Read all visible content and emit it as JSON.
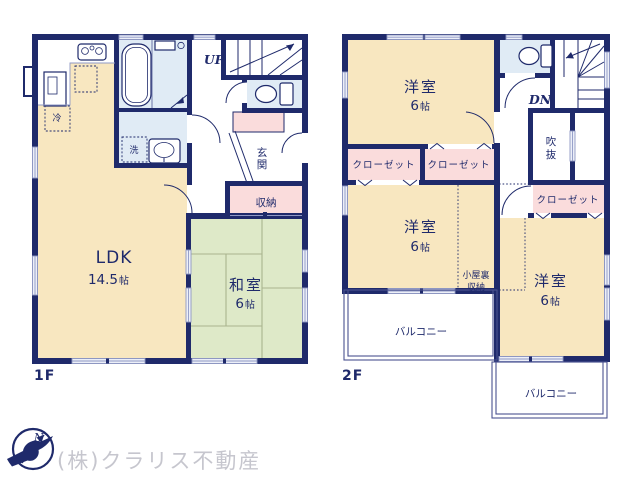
{
  "title": "floor-plan",
  "colors": {
    "wall_navy": "#1f2a6b",
    "ldk_cream": "#f8e7c0",
    "tatami_green": "#dee9c8",
    "wet_area_blue": "#e0ebf5",
    "storage_pink": "#fadcdc",
    "window_light": "#eceff8",
    "tatami_line": "#a9b48e",
    "company_gray": "#c6c6ce"
  },
  "floor1": {
    "label": "1F",
    "ldk": {
      "name": "LDK",
      "size_num": "14.5",
      "size_unit": "帖"
    },
    "washitsu": {
      "name": "和室",
      "size_num": "6",
      "size_unit": "帖"
    },
    "genkan": {
      "line1": "玄",
      "line2": "関"
    },
    "storage": "収納",
    "fridge": "冷",
    "laundry": "洗",
    "stairs": "UP"
  },
  "floor2": {
    "label": "2F",
    "rooms": [
      {
        "name": "洋室",
        "size_num": "6",
        "size_unit": "帖"
      },
      {
        "name": "洋室",
        "size_num": "6",
        "size_unit": "帖"
      },
      {
        "name": "洋室",
        "size_num": "6",
        "size_unit": "帖"
      }
    ],
    "closet": "クローゼット",
    "void": {
      "line1": "吹",
      "line2": "抜"
    },
    "attic": {
      "line1": "小屋裏",
      "line2": "収納"
    },
    "balcony": "バルコニー",
    "stairs": "DN"
  },
  "compass": {
    "north": "N"
  },
  "footer": {
    "company": "(株)クラリス不動産"
  }
}
